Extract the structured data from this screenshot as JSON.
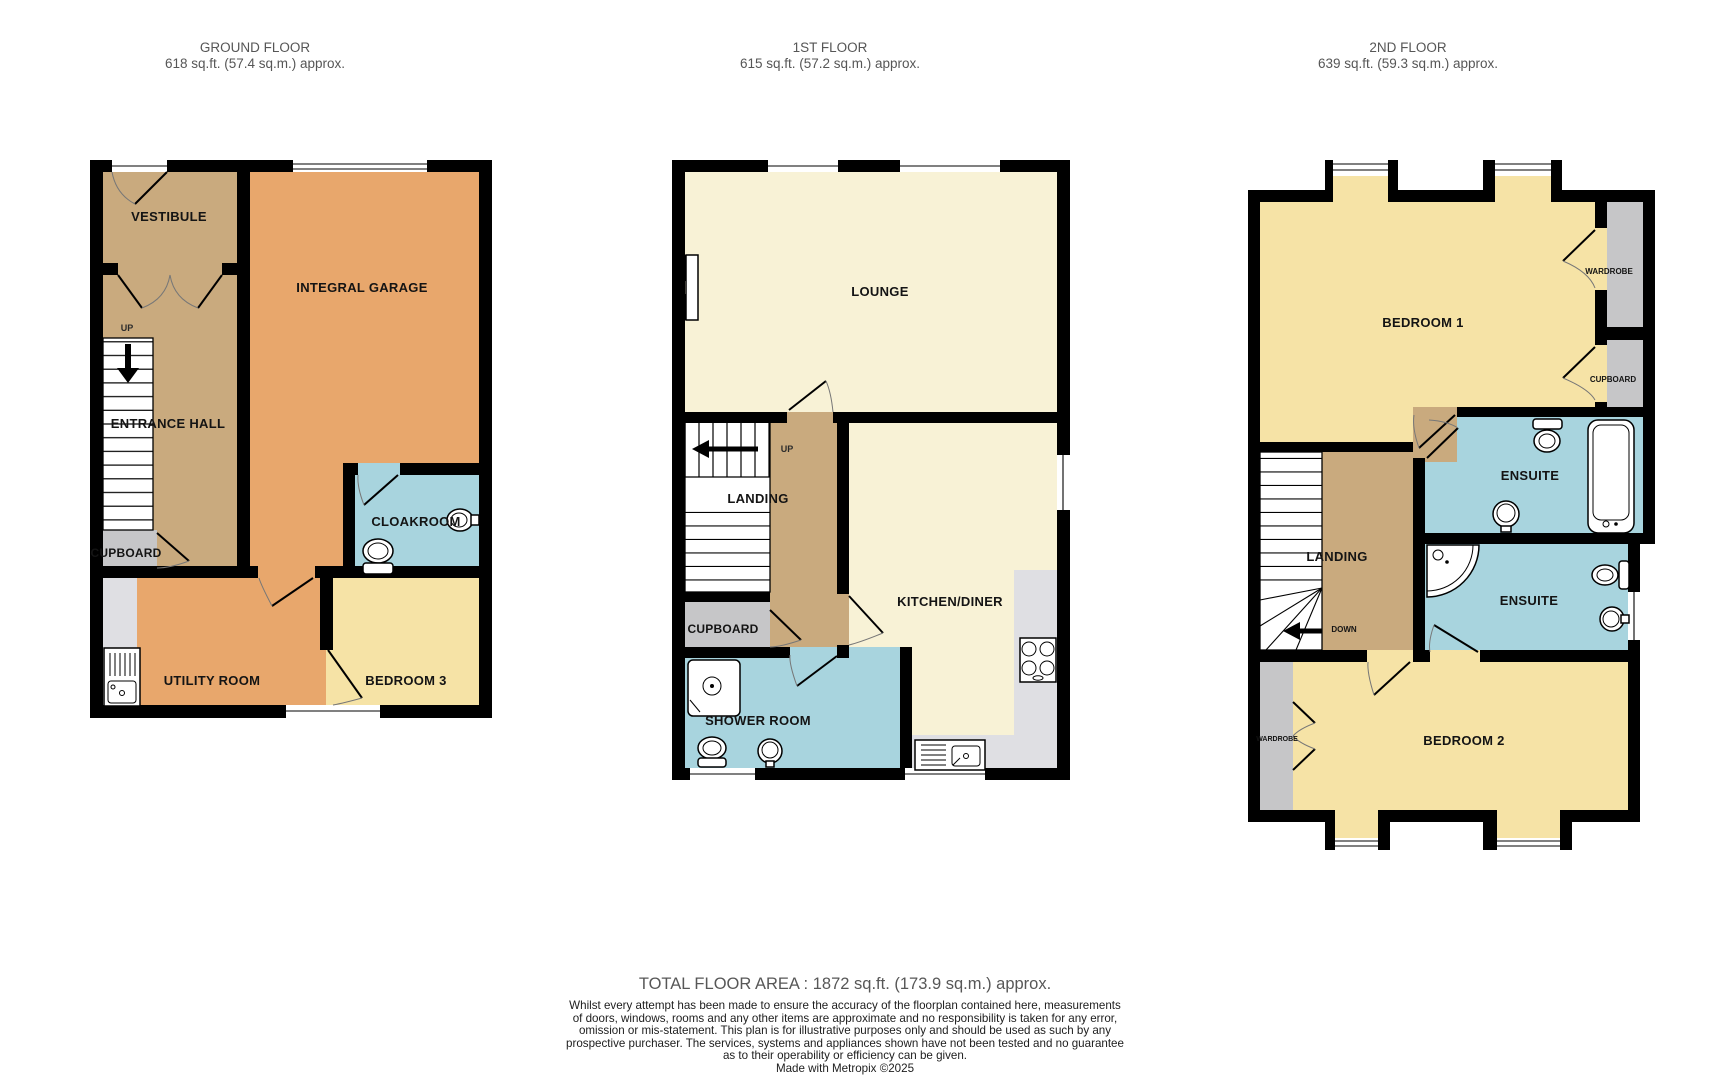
{
  "colors": {
    "wall": "#000000",
    "hall_tan": "#c9aa7e",
    "garage_orange": "#e8a76c",
    "lounge_cream": "#f8f2d6",
    "bedroom_yellow": "#f6e3a6",
    "bathroom_blue": "#a8d4de",
    "storage_gray": "#c6c6c8",
    "counter_gray": "#dfdfe3",
    "heading_text": "#565656",
    "label_text": "#141414"
  },
  "floors": [
    {
      "title": "GROUND FLOOR",
      "area": "618 sq.ft. (57.4 sq.m.) approx.",
      "rooms": {
        "vestibule": "VESTIBULE",
        "garage": "INTEGRAL GARAGE",
        "entrance_hall": "ENTRANCE HALL",
        "cupboard": "CUPBOARD",
        "cloakroom": "CLOAKROOM",
        "utility": "UTILITY ROOM",
        "bedroom3": "BEDROOM 3"
      },
      "stairs": {
        "up": "UP"
      }
    },
    {
      "title": "1ST FLOOR",
      "area": "615 sq.ft. (57.2 sq.m.) approx.",
      "rooms": {
        "lounge": "LOUNGE",
        "landing": "LANDING",
        "cupboard": "CUPBOARD",
        "kitchen": "KITCHEN/DINER",
        "shower_room": "SHOWER ROOM"
      },
      "stairs": {
        "up": "UP"
      }
    },
    {
      "title": "2ND FLOOR",
      "area": "639 sq.ft. (59.3 sq.m.) approx.",
      "rooms": {
        "bedroom1": "BEDROOM 1",
        "wardrobe": "WARDROBE",
        "cupboard": "CUPBOARD",
        "ensuite1": "ENSUITE",
        "ensuite2": "ENSUITE",
        "landing": "LANDING",
        "bedroom2": "BEDROOM 2",
        "wardrobe2": "WARDROBE"
      },
      "stairs": {
        "down": "DOWN"
      }
    }
  ],
  "footer": {
    "total": "TOTAL FLOOR AREA : 1872 sq.ft. (173.9 sq.m.) approx.",
    "disclaimer": [
      "Whilst every attempt has been made to ensure the accuracy of the floorplan contained here, measurements",
      "of doors, windows, rooms and any other items are approximate and no responsibility is taken for any error,",
      "omission or mis-statement. This plan is for illustrative purposes only and should be used as such by any",
      "prospective purchaser. The services, systems and appliances shown have not been tested and no guarantee",
      "as to their operability or efficiency can be given."
    ],
    "credit": "Made with Metropix ©2025"
  }
}
